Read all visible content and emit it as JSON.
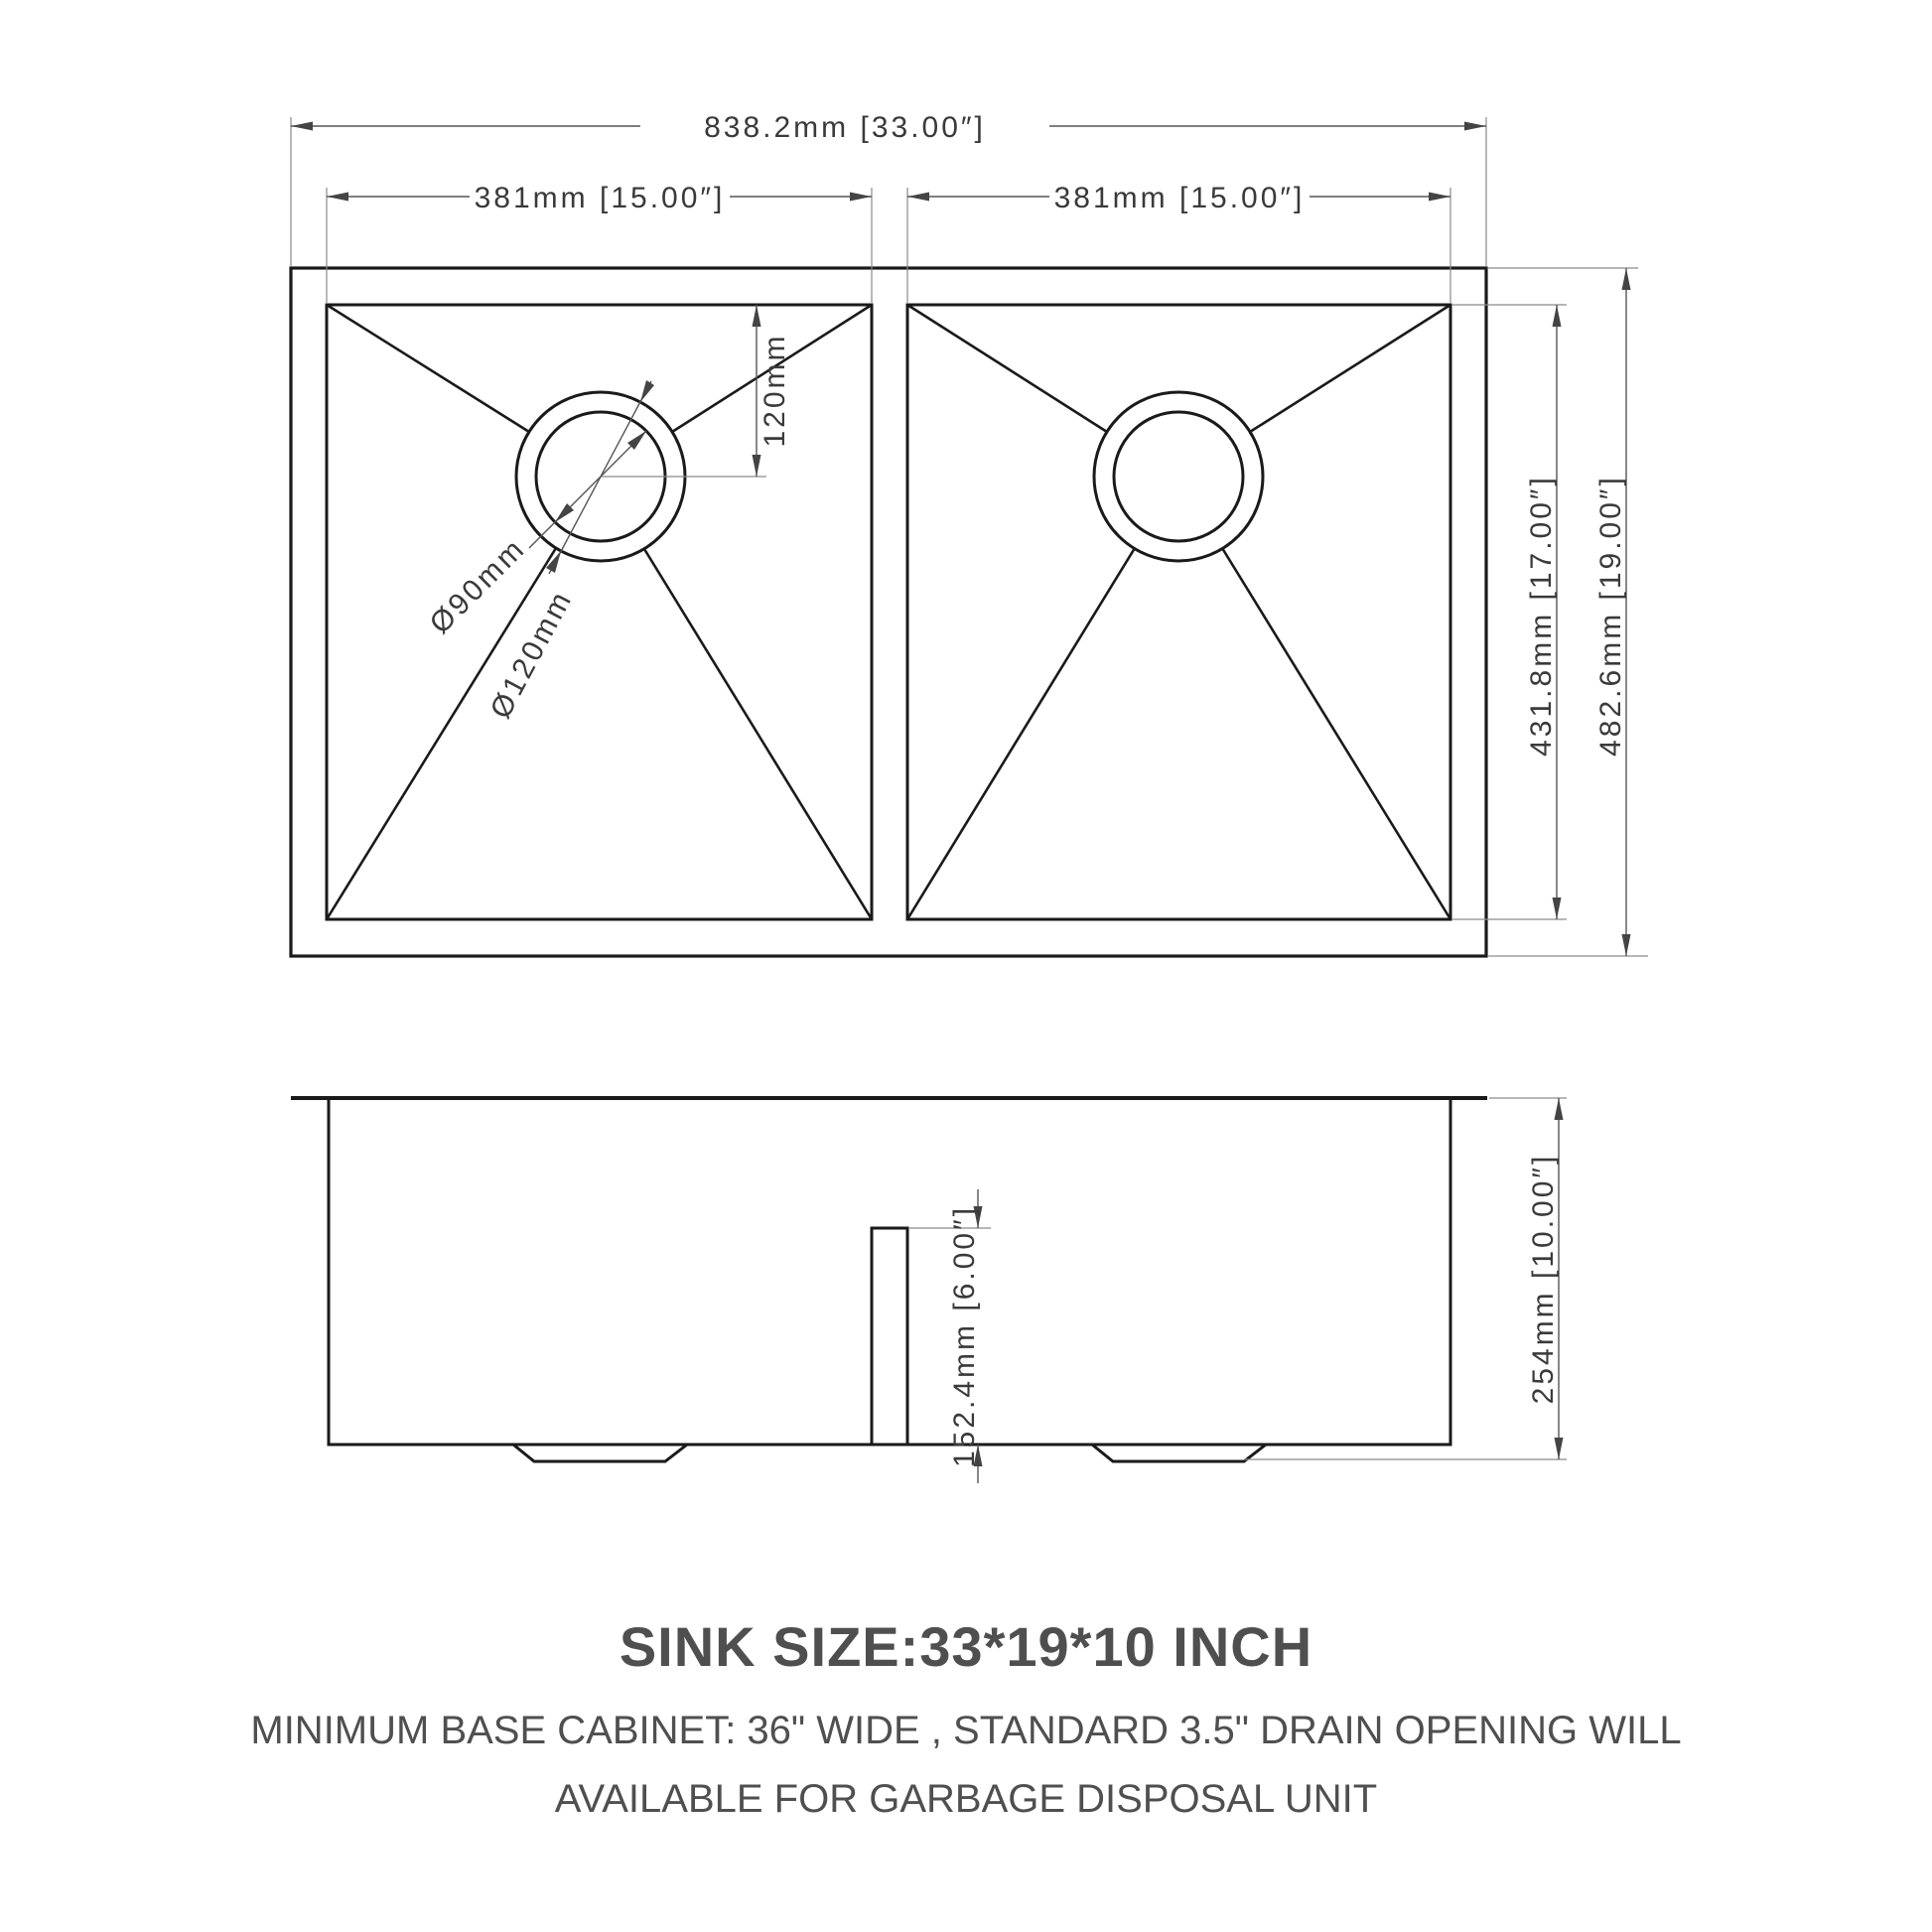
{
  "drawing": {
    "top_view": {
      "overall_width": "838.2mm [33.00″]",
      "left_bowl_width": "381mm [15.00″]",
      "right_bowl_width": "381mm [15.00″]",
      "drain_center_offset": "120mm",
      "drain_inner_diameter": "Ø90mm",
      "drain_outer_diameter": "Ø120mm",
      "bowl_front_back": "431.8mm [17.00″]",
      "overall_front_back": "482.6mm [19.00″]"
    },
    "side_view": {
      "divider_height": "152.4mm [6.00″]",
      "overall_depth": "254mm [10.00″]"
    }
  },
  "notes": {
    "title": "SINK SIZE:33*19*10 INCH",
    "line1": "MINIMUM BASE CABINET: 36\" WIDE , STANDARD 3.5\" DRAIN OPENING WILL",
    "line2": "AVAILABLE FOR GARBAGE DISPOSAL UNIT"
  },
  "colors": {
    "outline_ink": "#1a1a1a",
    "dimension_line": "#555555",
    "extension_line": "#8a8a8a",
    "dimension_text": "#3a3a3a",
    "note_text": "#4f4f4f",
    "background": "#ffffff"
  }
}
